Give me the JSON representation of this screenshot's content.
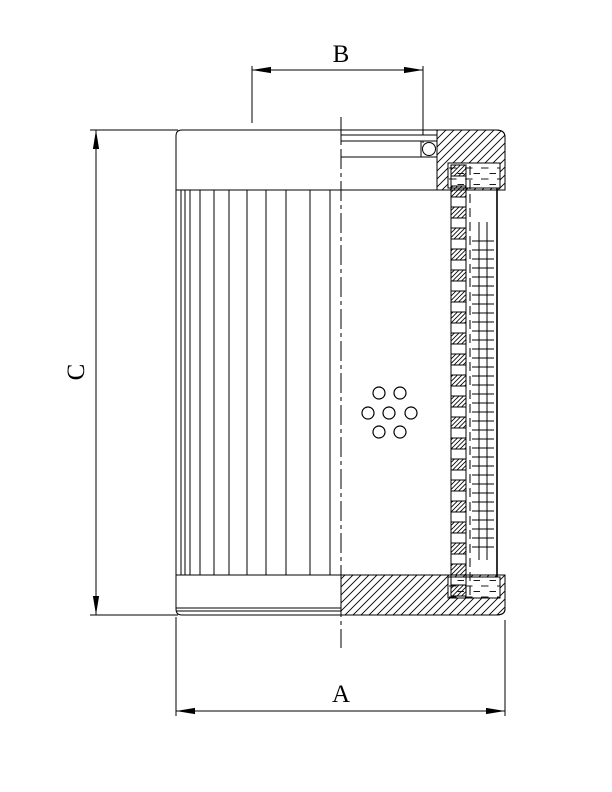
{
  "page": {
    "width": 612,
    "height": 792,
    "background": "#ffffff",
    "line_color": "#000000",
    "description": "Dimensioned cross-section technical drawing of a cylindrical hydraulic filter element"
  },
  "labels": {
    "dim_outer_diameter": "A",
    "dim_inner_opening": "B",
    "dim_height": "C"
  },
  "drawing": {
    "centerline": {
      "x": 341,
      "y1": 117,
      "y2": 648,
      "dash": "20,4,4,4"
    },
    "pleats": {
      "outline_x": 176,
      "x_positions": [
        181,
        185,
        190,
        200,
        214,
        229,
        247,
        266,
        286,
        310,
        330
      ],
      "y1": 190,
      "y2": 575
    },
    "tube": {
      "x": 451,
      "w": 15,
      "start_y": 165,
      "square_h": 11,
      "period": 21,
      "end_y": 598
    },
    "mesh": {
      "dashed_x": 470,
      "dashed_y1": 166,
      "dashed_y2": 596,
      "dash": "9,5",
      "vert_x1": 479,
      "vert_x2": 487,
      "vert_y1": 222,
      "vert_y2": 560,
      "rung_x1": 472,
      "rung_x2": 494,
      "rung_y1": 241,
      "rung_y2": 553,
      "rung_step": 9
    },
    "holes": {
      "r": 6,
      "centers": [
        [
          379,
          393
        ],
        [
          400,
          393
        ],
        [
          368,
          413
        ],
        [
          389,
          413
        ],
        [
          411,
          413
        ],
        [
          379,
          432
        ],
        [
          400,
          432
        ]
      ]
    }
  }
}
